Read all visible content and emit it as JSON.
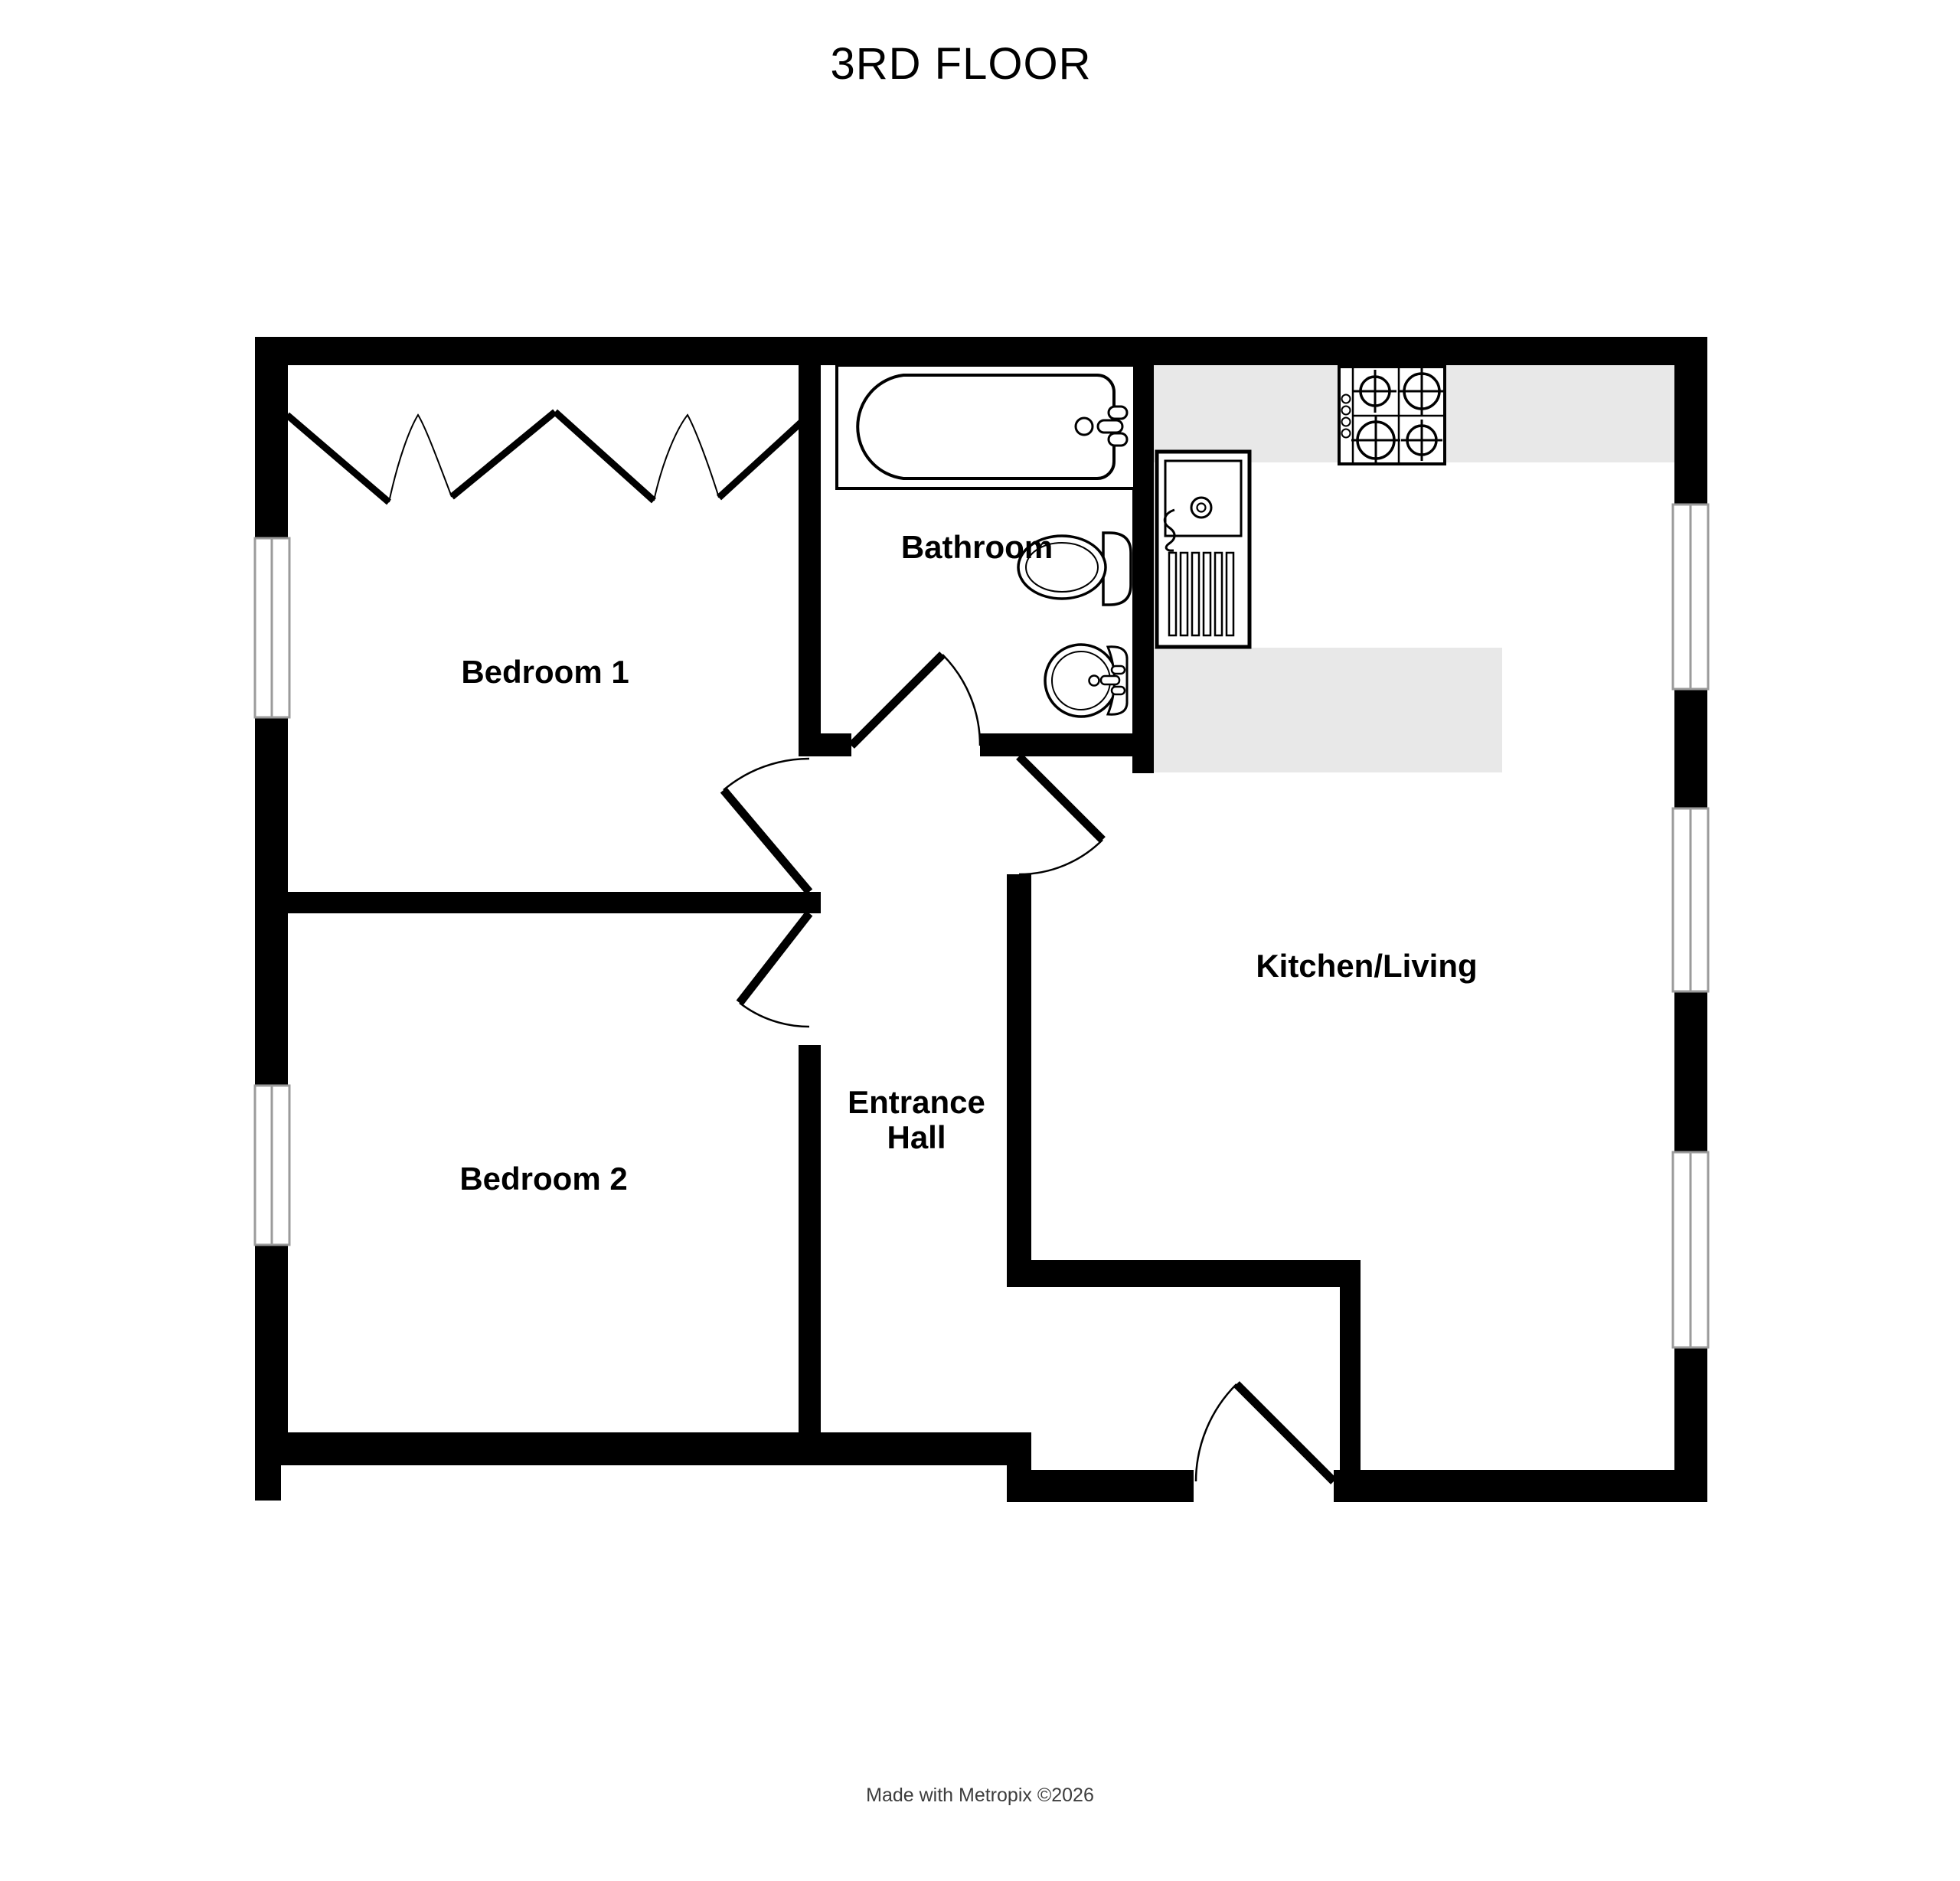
{
  "title": "3RD FLOOR",
  "footer": "Made with Metropix ©2026",
  "rooms": {
    "bedroom1": "Bedroom 1",
    "bathroom": "Bathroom",
    "kitchen_living": "Kitchen/Living",
    "bedroom2": "Bedroom 2",
    "entrance_line1": "Entrance",
    "entrance_line2": "Hall"
  },
  "fixtures": {
    "bathtub": "bathtub",
    "toilet": "toilet",
    "wash_basin": "wash-basin",
    "kitchen_sink": "kitchen-sink-with-drainer",
    "gas_hob": "4-burner-gas-hob",
    "wardrobe": "wardrobe-zigzag"
  },
  "doors": [
    "bedroom-1-door",
    "bedroom-2-door",
    "bathroom-door",
    "kitchen-living-door",
    "front-entrance-door"
  ],
  "windows": {
    "left_wall": 2,
    "right_wall": 3
  },
  "colors": {
    "wall": "#000000",
    "line": "#000000",
    "text": "#000000",
    "counter": "#e8e8e8",
    "window_frame": "#9b9b9b",
    "background": "#ffffff",
    "footer_text": "#3d3d3d"
  }
}
